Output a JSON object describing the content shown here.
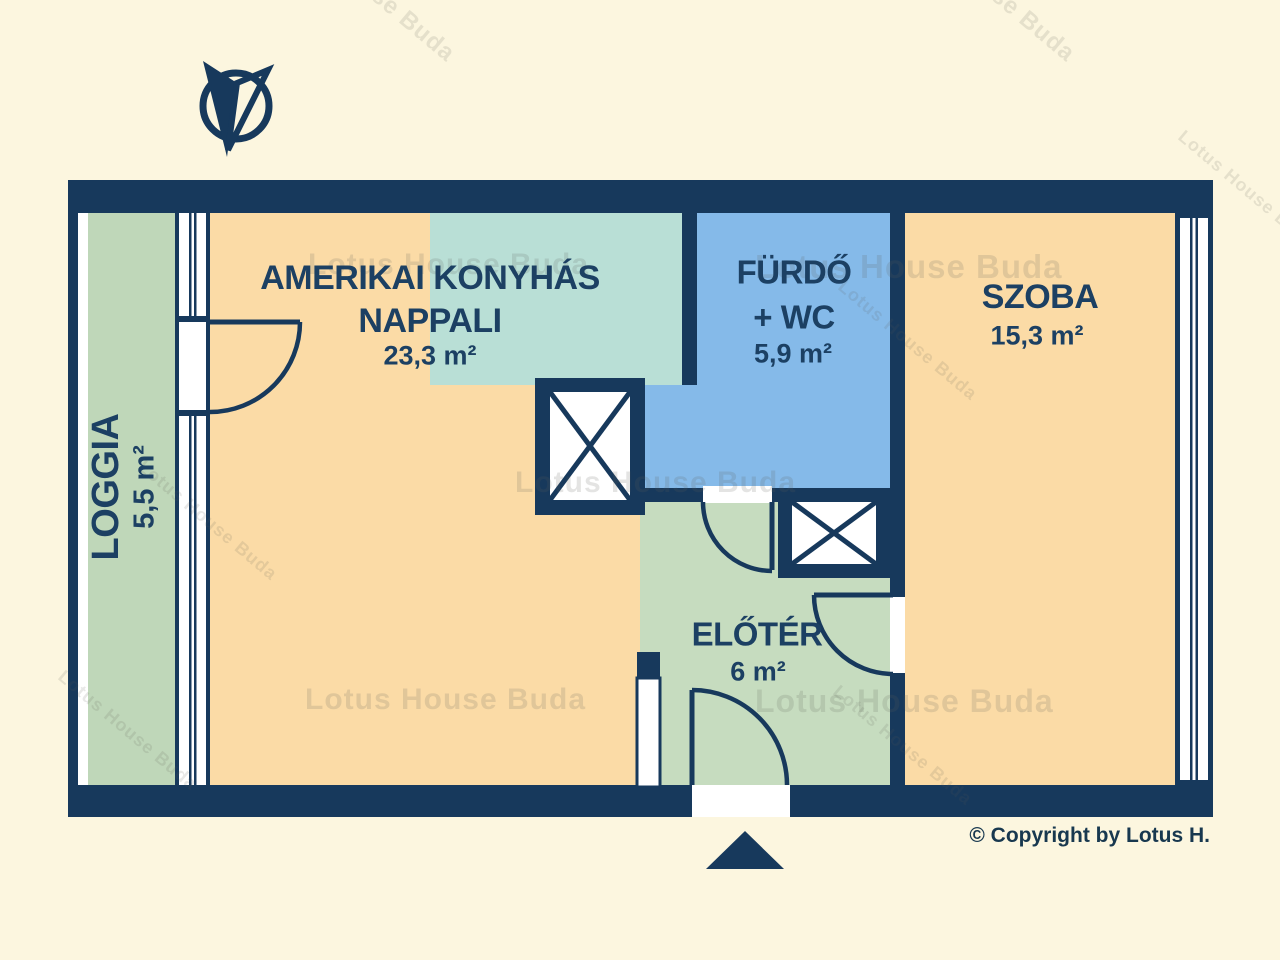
{
  "rooms": {
    "living": {
      "line1": "AMERIKAI KONYHÁS",
      "line2": "NAPPALI",
      "area": "23,3 m²"
    },
    "bathroom": {
      "line1": "FÜRDŐ",
      "line2": "+ WC",
      "area": "5,9 m²"
    },
    "room": {
      "label": "SZOBA",
      "area": "15,3 m²"
    },
    "hall": {
      "label": "ELŐTÉR",
      "area": "6 m²"
    },
    "loggia": {
      "label": "LOGGIA",
      "area": "5,5 m²"
    }
  },
  "footer": {
    "copyright": "© Copyright by Lotus H."
  },
  "watermark": {
    "text": "Lotus House Buda"
  },
  "colors": {
    "background": "#FCF6DF",
    "wall": "#17395C",
    "living_floor": "#FBDBA6",
    "kitchen_zone": "#B9DFD6",
    "bathroom_floor": "#85BAE9",
    "loggia_floor": "#BFD7B9",
    "hall_floor": "#C6DCBF",
    "room_floor": "#FBDBA6",
    "text": "#1C4063"
  }
}
